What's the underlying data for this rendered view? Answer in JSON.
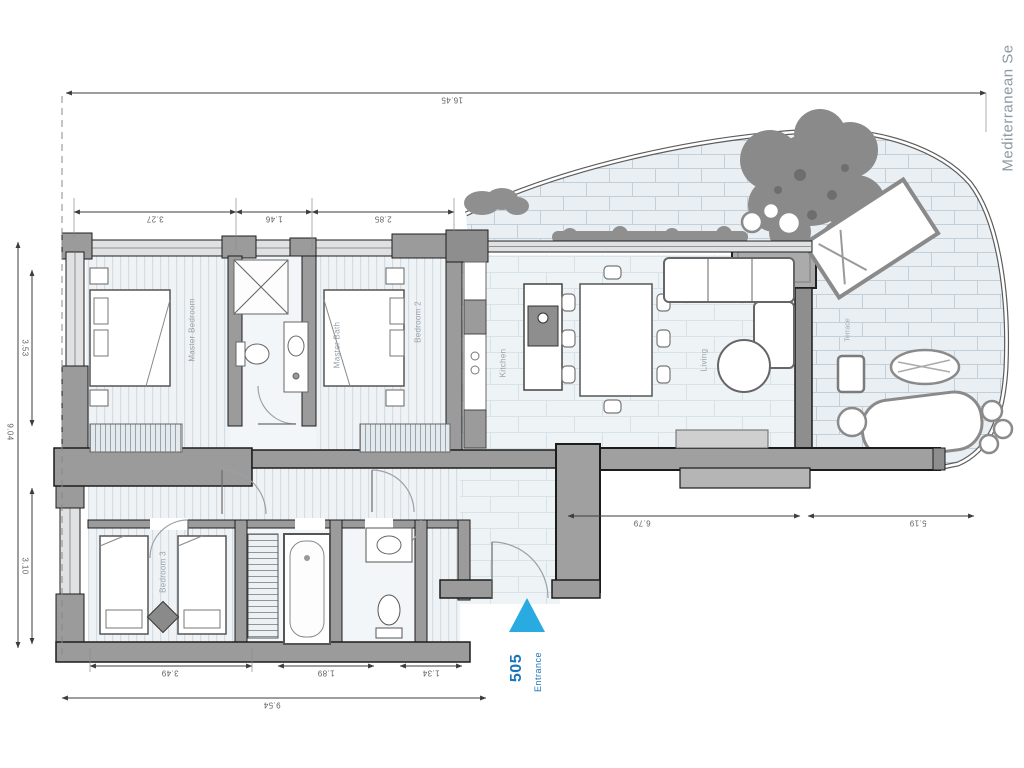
{
  "plan": {
    "unit_number": "505",
    "entrance_label": "Entrance",
    "sea_label": "Mediterranean Se",
    "rooms": {
      "master_bedroom": "Master Bedroom",
      "master_bath": "Master Bath",
      "bedroom_2": "Bedroom 2",
      "kitchen": "Kitchen",
      "living": "Living",
      "bedroom_3": "Bedroom 3",
      "terrace": "Terrace"
    },
    "dimensions": {
      "top_total": "16.45",
      "top_segments": [
        "3.27",
        "1.46",
        "2.85"
      ],
      "left_total": "9.04",
      "left_upper": "3.53",
      "left_lower": "3.10",
      "bottom_segments": [
        "3.49",
        "1.89",
        "1.34"
      ],
      "bottom_total": "9.54",
      "right_inner": "6.79",
      "right_outer": "5.19"
    },
    "colors": {
      "entrance_blue": "#29abe2",
      "entrance_text_blue": "#1a75bb",
      "wall_gray": "#9b9b9b",
      "dimension_text": "#5f5f5f",
      "room_label_gray": "#98a1a8",
      "sea_label_gray": "#8e99a3"
    }
  }
}
